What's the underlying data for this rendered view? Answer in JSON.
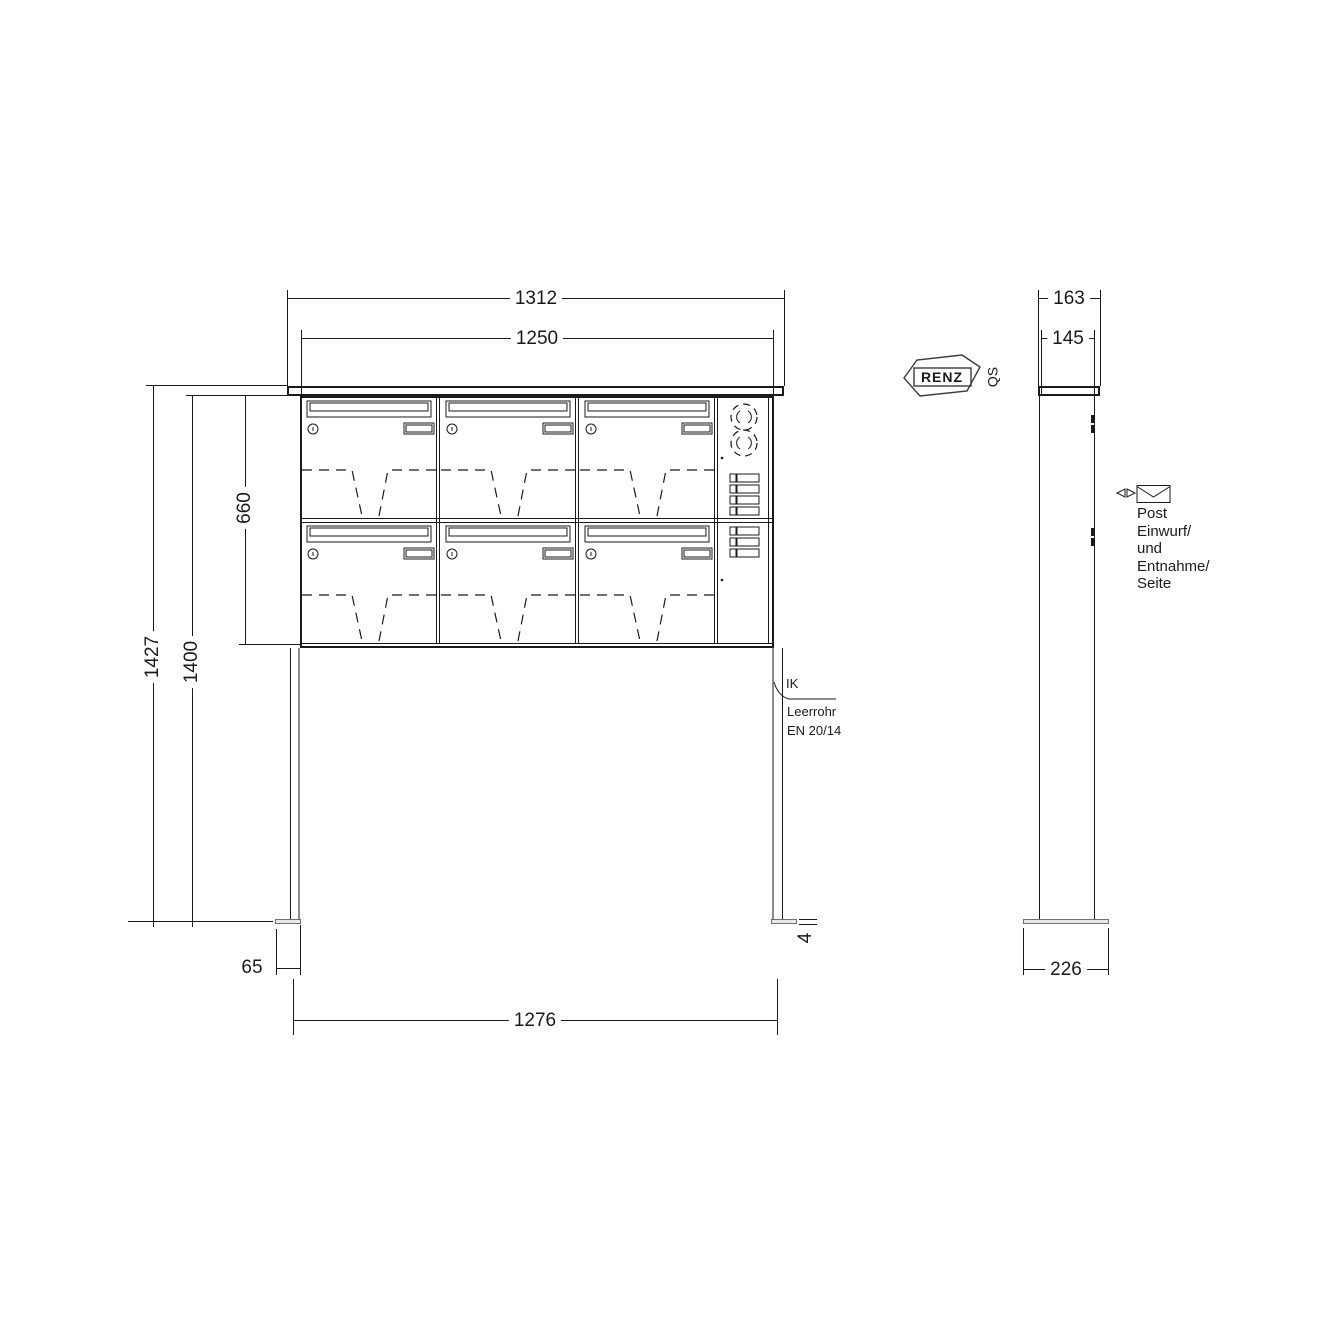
{
  "front_view": {
    "dims": {
      "width_outer": "1312",
      "width_inner": "1250",
      "height_total": "1427",
      "height_to_box_top": "1400",
      "box_height": "660",
      "foot_plate_width": "65",
      "anchor_span": "1276",
      "foot_plate_thickness": "4"
    },
    "leader_note": {
      "line1": "IK",
      "line2": "Leerrohr",
      "line3": "EN 20/14"
    }
  },
  "side_view": {
    "dims": {
      "depth_outer": "163",
      "depth_inner": "145",
      "foot_plate_depth": "226"
    },
    "note_lines": [
      "Post",
      "Einwurf/",
      "und",
      "Entnahme/",
      "Seite"
    ]
  },
  "logo": {
    "brand": "RENZ",
    "qs": "QS"
  },
  "colors": {
    "line": "#1a1a1a",
    "gray_line": "#8c8c8c",
    "background": "#ffffff"
  }
}
